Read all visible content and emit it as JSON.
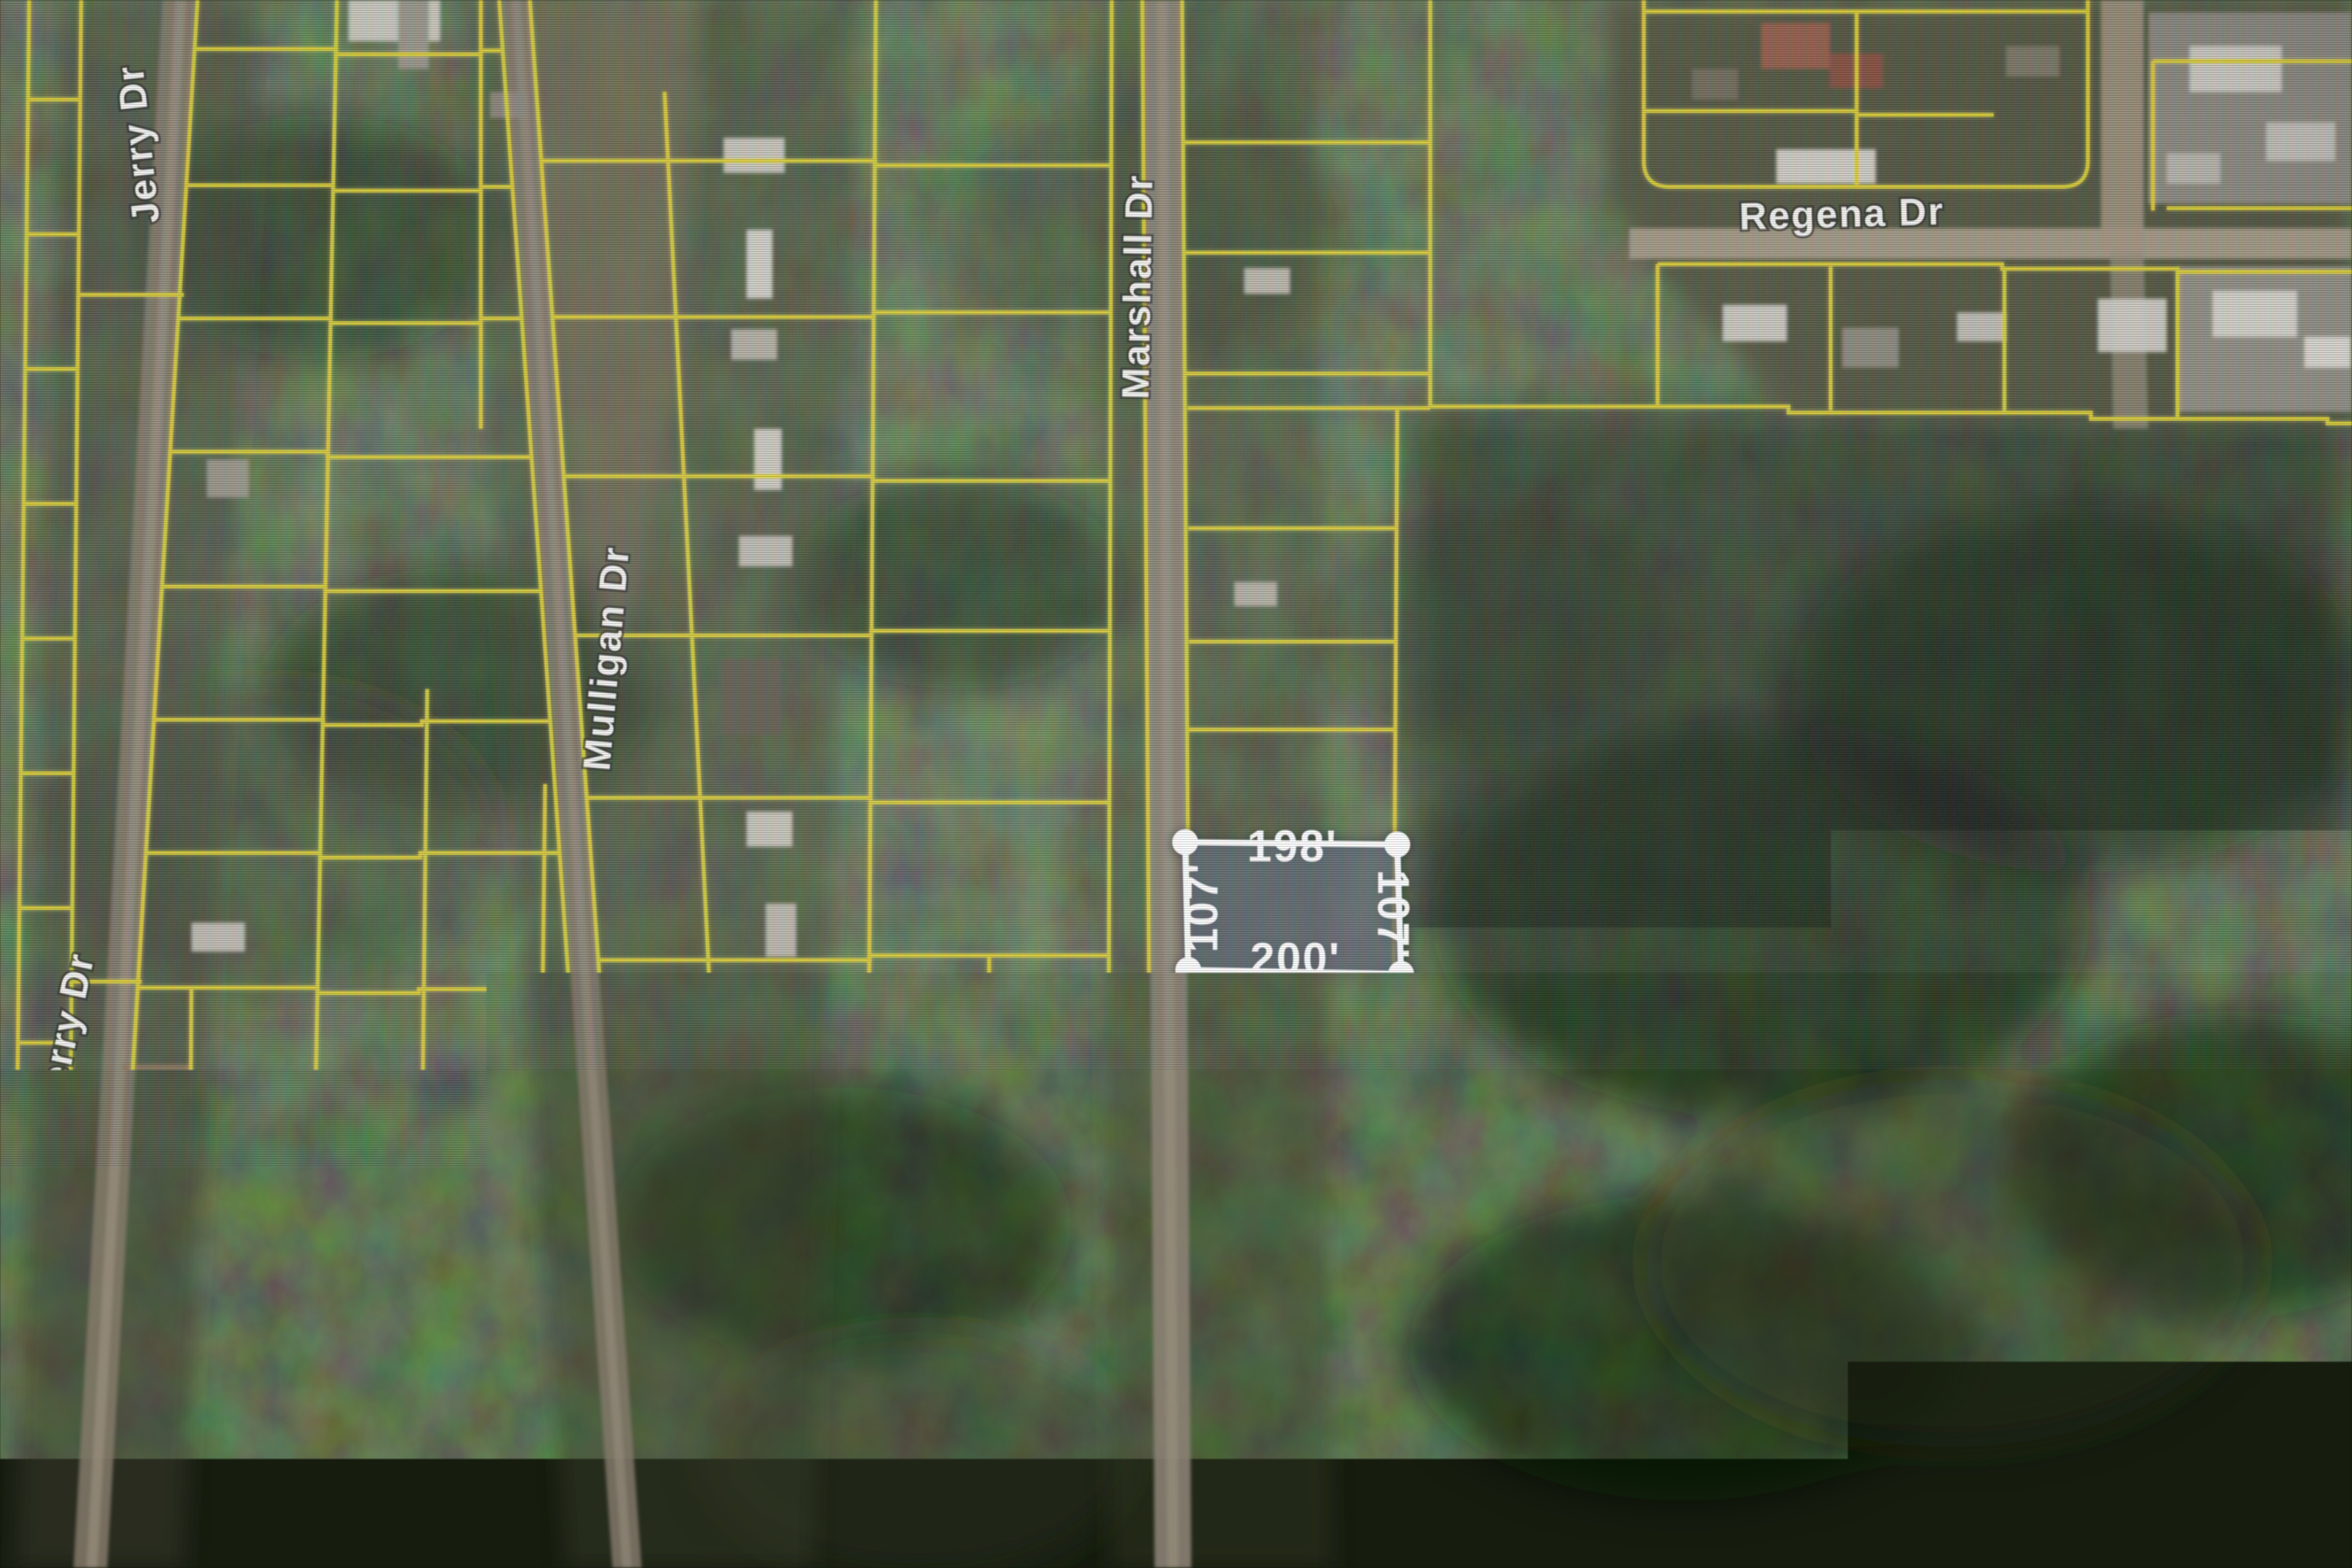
{
  "map": {
    "street_labels": {
      "jerry_dr": "Jerry Dr",
      "mulligan_dr": "Mulligan Dr",
      "marshall_dr": "Marshall Dr",
      "regena_dr": "Regena Dr"
    },
    "selected_parcel": {
      "dim_top": "198'",
      "dim_bottom": "200'",
      "dim_left": "107'",
      "dim_right": "107'"
    },
    "attribution": "© 2023 TomTom, © Vexcel Imaging, © 2023 Micr",
    "colors": {
      "parcel_line": "#ddcf25",
      "selection_fill": "rgba(118,128,150,0.5)",
      "measure_line": "#ffffff",
      "scalebar_blue": "#2f7bed",
      "strip_bg": "#e9e9ee",
      "logo_blue": "#1d5a9c",
      "logo_green": "#3f9b42"
    }
  },
  "branding": {
    "mls_line1": "GREATER",
    "mls_line2": "ALABAMA",
    "mls_line3": "MLS"
  }
}
